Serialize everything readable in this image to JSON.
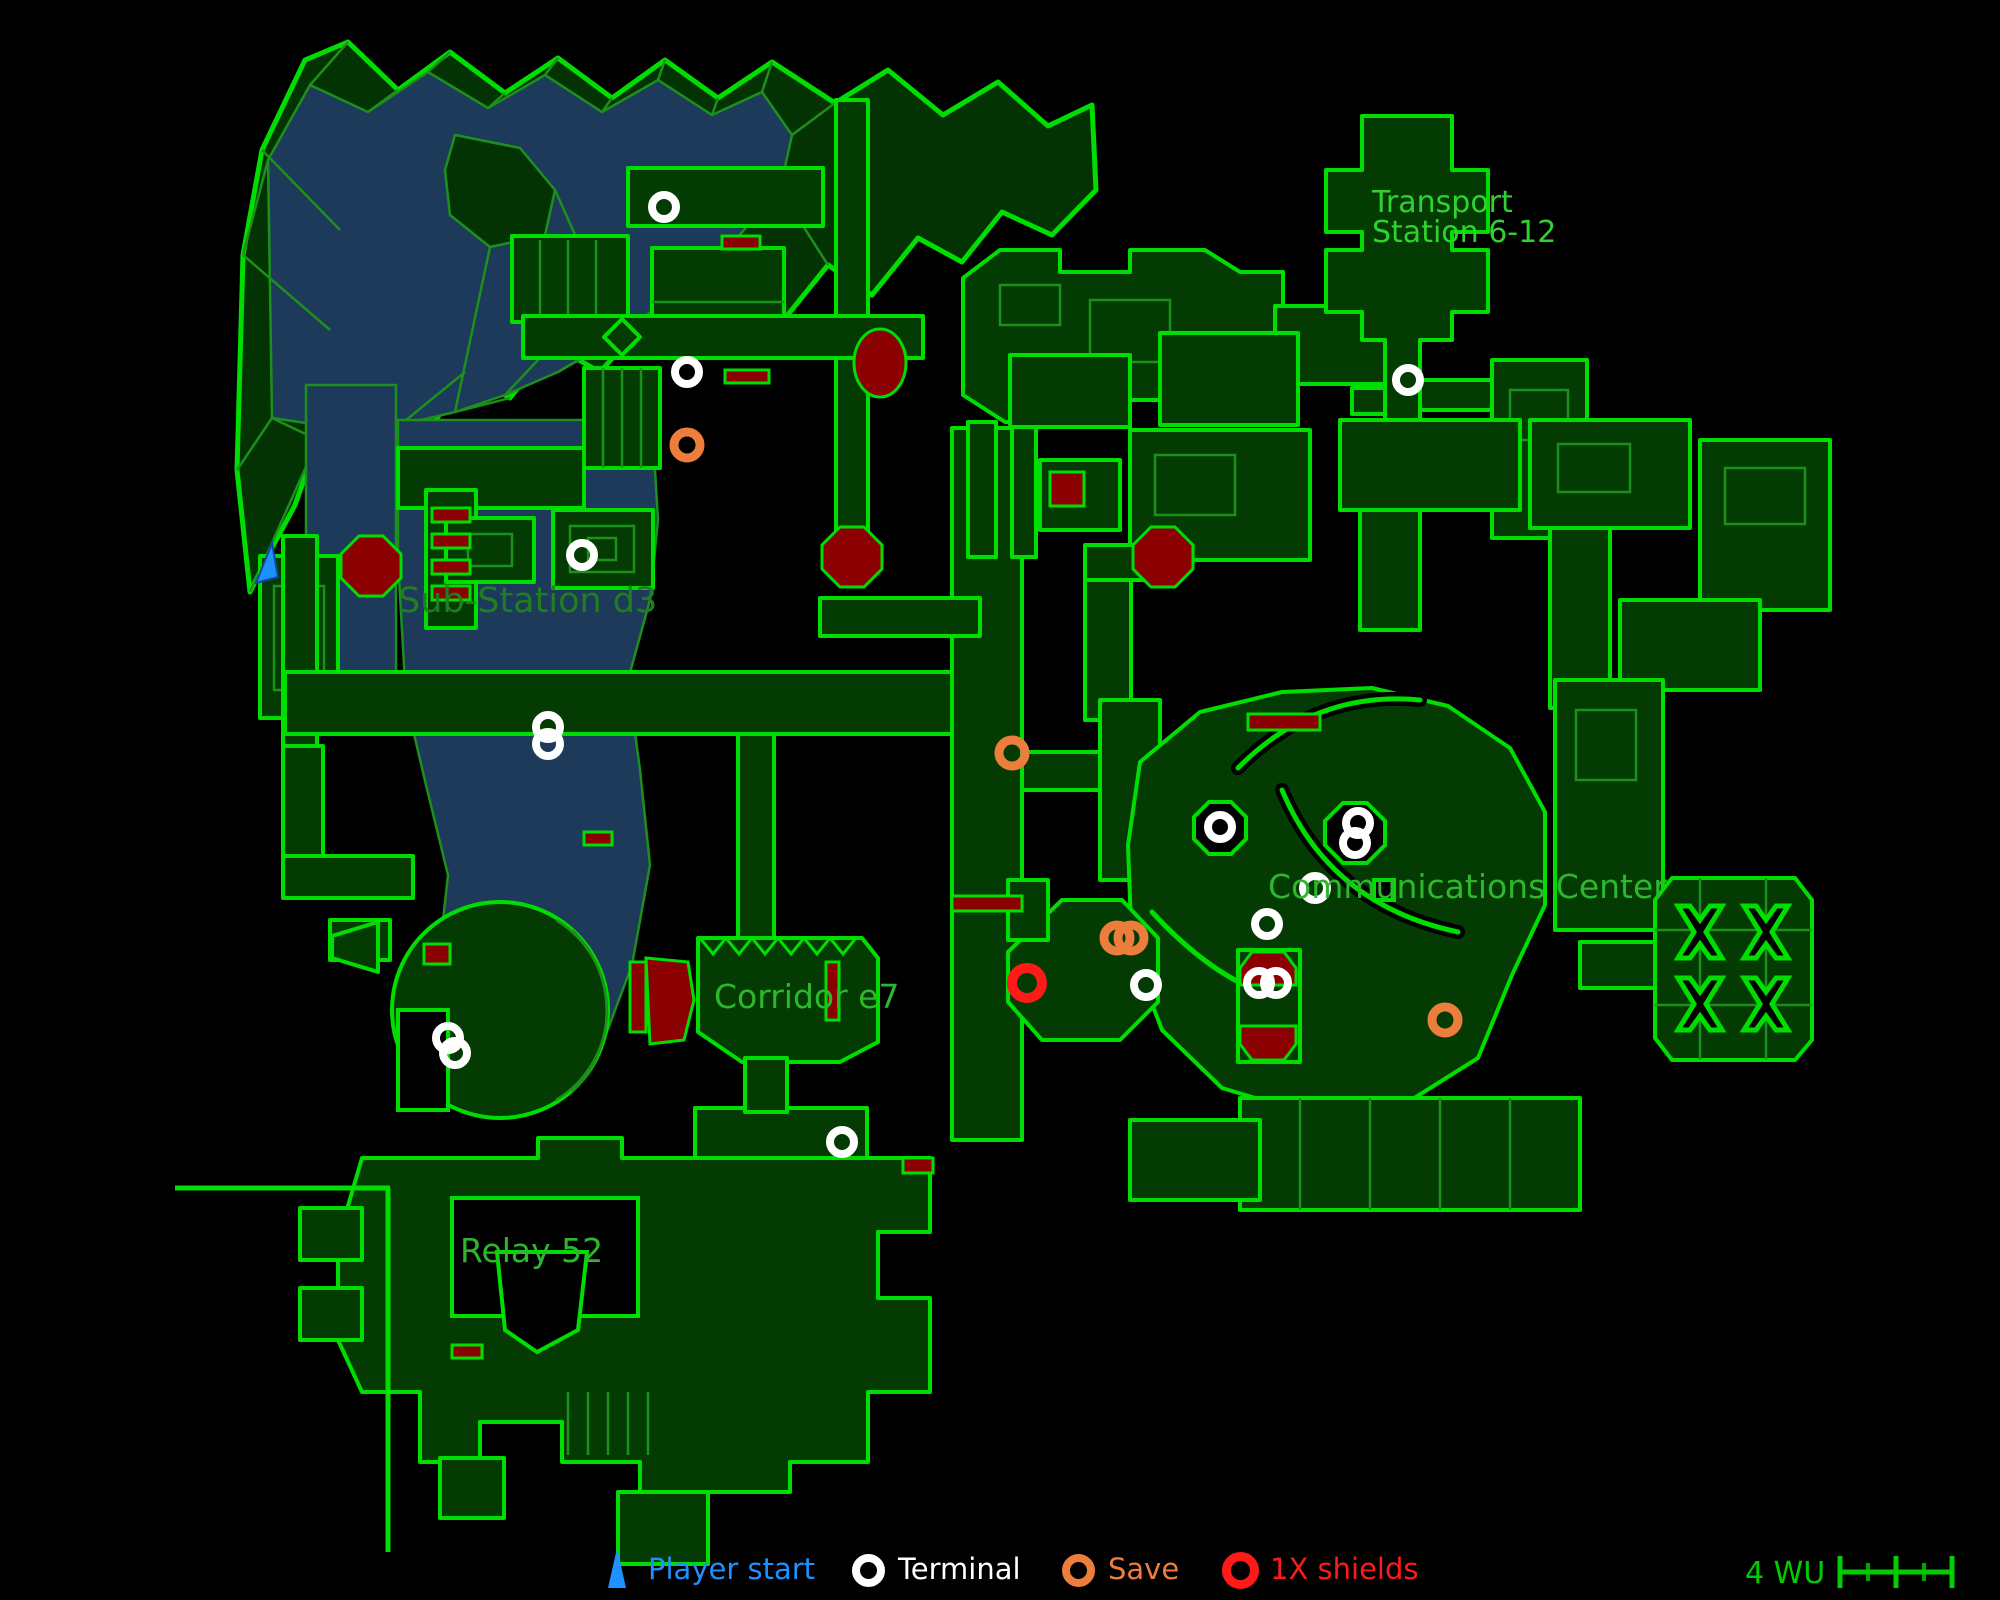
{
  "palette": {
    "background": "#000000",
    "wall_green": "#00dd00",
    "wall_dim_green": "#1d8f1d",
    "room_fill": "#033b03",
    "water_navy": "#1d3a5a",
    "hazard_dark_red": "#8b0000",
    "shield_red": "#ff1a1a",
    "save_orange": "#ed7d3c",
    "player_blue": "#1e90ff",
    "terminal_white": "#ffffff",
    "label_green": "#2eb62e",
    "scale_green": "#00cc00"
  },
  "labels": {
    "transport_line1": "Transport",
    "transport_line2": "Station 6-12",
    "sub_station": "Sub-Station d3",
    "comm_center": "Communications Center",
    "corridor": "Corridor e7",
    "relay": "Relay 52"
  },
  "markers": {
    "player_start": {
      "x": 265,
      "y": 563
    },
    "terminals": [
      {
        "x": 664,
        "y": 207
      },
      {
        "x": 687,
        "y": 372
      },
      {
        "x": 582,
        "y": 555
      },
      {
        "x": 548,
        "y": 727
      },
      {
        "x": 548,
        "y": 744
      },
      {
        "x": 448,
        "y": 1038
      },
      {
        "x": 455,
        "y": 1053
      },
      {
        "x": 842,
        "y": 1142
      },
      {
        "x": 1408,
        "y": 380
      },
      {
        "x": 1220,
        "y": 827
      },
      {
        "x": 1358,
        "y": 823
      },
      {
        "x": 1355,
        "y": 843
      },
      {
        "x": 1315,
        "y": 888
      },
      {
        "x": 1267,
        "y": 924
      },
      {
        "x": 1259,
        "y": 983
      },
      {
        "x": 1276,
        "y": 983
      },
      {
        "x": 1146,
        "y": 985
      }
    ],
    "saves": [
      {
        "x": 687,
        "y": 445
      },
      {
        "x": 1012,
        "y": 753
      },
      {
        "x": 1117,
        "y": 938
      },
      {
        "x": 1131,
        "y": 938
      },
      {
        "x": 1445,
        "y": 1020
      }
    ],
    "shields": [
      {
        "x": 1027,
        "y": 983
      }
    ]
  },
  "legend": {
    "items": [
      {
        "type": "player_start",
        "label": "Player start",
        "color": "#1e90ff"
      },
      {
        "type": "terminal",
        "label": "Terminal",
        "color": "#ffffff"
      },
      {
        "type": "save",
        "label": "Save",
        "color": "#ed7d3c"
      },
      {
        "type": "shields",
        "label": "1X shields",
        "color": "#ff1a1a"
      }
    ],
    "scale": {
      "label": "4 WU"
    }
  }
}
